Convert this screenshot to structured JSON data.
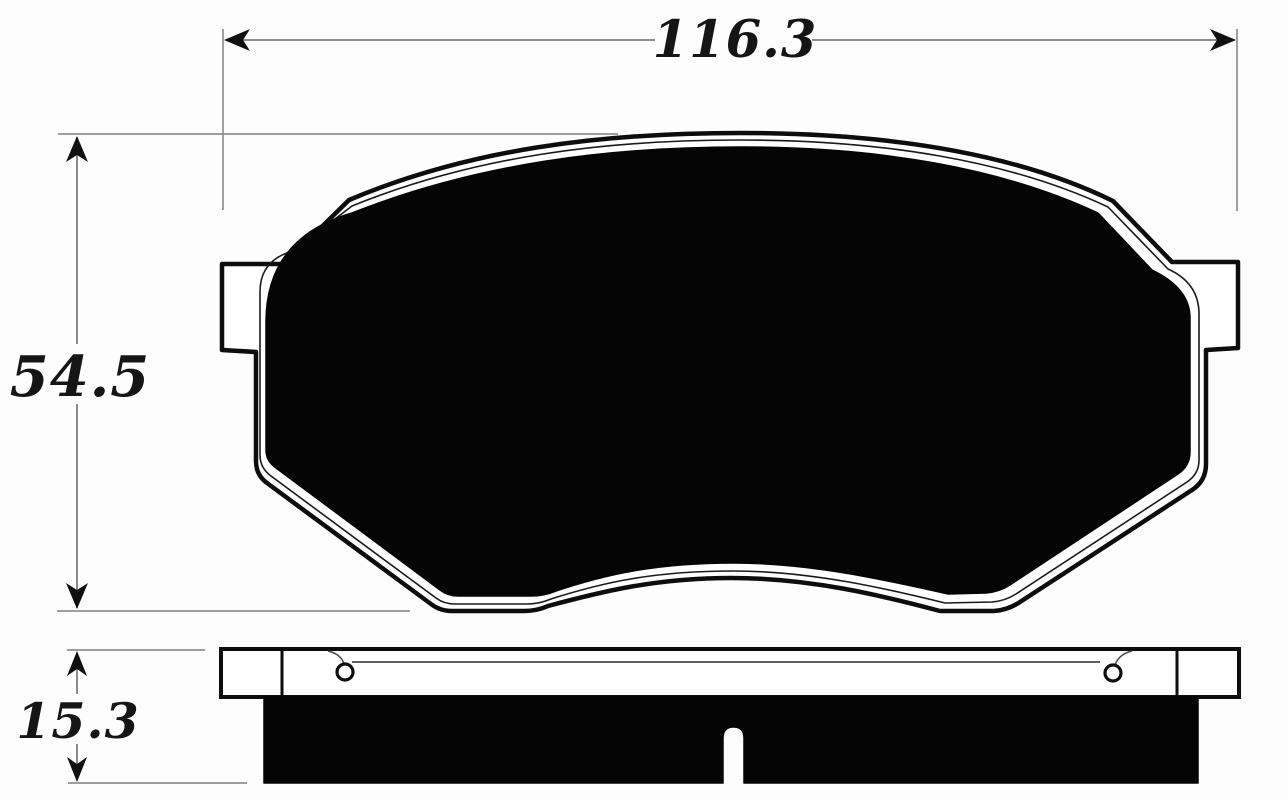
{
  "drawing": {
    "dimensions": {
      "width_label": "116.3",
      "height_label": "54.5",
      "thickness_label": "15.3"
    },
    "colors": {
      "background": "#fdfdfd",
      "outline": "#0d0d0d",
      "friction_fill": "#050505",
      "dimension_line": "#8c8c8c",
      "label_text": "#151515"
    }
  }
}
